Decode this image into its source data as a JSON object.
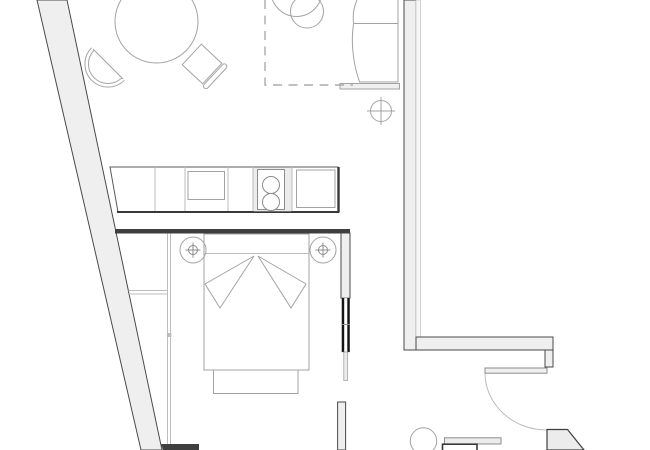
{
  "document": {
    "type": "apartment-floor-plan",
    "visible_text": []
  },
  "colors": {
    "background": "#ffffff",
    "wall_fill": "#efefef",
    "wall_fill_light": "#f7f7f7",
    "wall_edge": "#4a4a4a",
    "wall_edge_light": "#c9c9c9",
    "dark_wall": "#3f3f3f",
    "door_black": "#141414",
    "counter_edge": "#383838",
    "counter_outline": "#5a5a5a",
    "divider_stroke": "#bdbdbd",
    "furniture_stroke": "#a3a3a3",
    "fixture_stroke": "#8c8c8c",
    "dashed_stroke": "#ababab",
    "arc_stroke": "#bdbdbd",
    "fill_light": "#ececec",
    "fill_soft": "#f0f0f0",
    "fill_white": "#ffffff"
  },
  "rooms": {
    "living_dining": {
      "name": "living-dining-area",
      "furniture": [
        "round-dining-table",
        "tub-chair",
        "side-chair",
        "dashed-rug",
        "plant",
        "armchair",
        "ceiling-light-symbol"
      ]
    },
    "kitchen": {
      "name": "kitchen-counter-run",
      "furniture": [
        "counter",
        "sink-basin",
        "cooktop-two-burners",
        "appliance-square"
      ]
    },
    "bedroom": {
      "name": "bedroom",
      "furniture": [
        "double-bed",
        "folded-blanket",
        "foot-bench",
        "nightstand-left",
        "nightstand-right",
        "socket-symbol-left",
        "socket-symbol-right",
        "closet-partition",
        "shelf",
        "pocket-door"
      ]
    },
    "entry_bath": {
      "name": "entry-and-bathroom",
      "furniture": [
        "swing-door",
        "door-arc",
        "toilet",
        "vanity-counter",
        "vanity-cabinet",
        "wall-return"
      ]
    }
  }
}
